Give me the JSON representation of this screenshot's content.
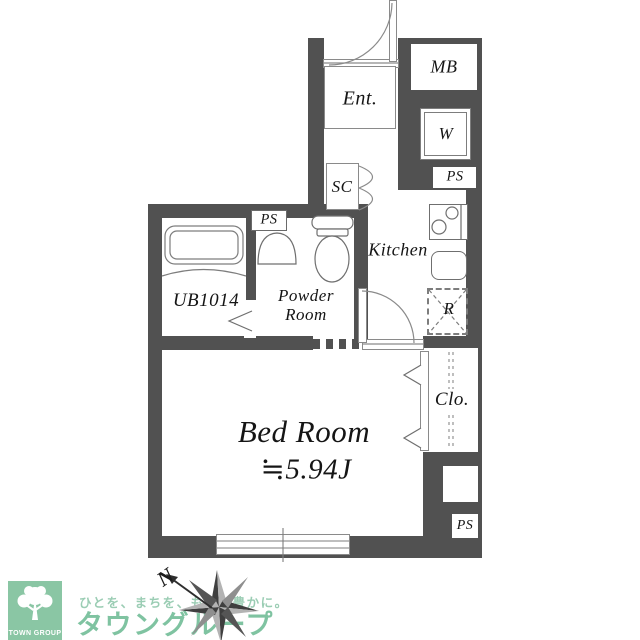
{
  "plan": {
    "ent": "Ent.",
    "mb": "MB",
    "w": "W",
    "ps": "PS",
    "sc": "SC",
    "kitchen": "Kitchen",
    "ub": "UB1014",
    "powder": "Powder Room",
    "r": "R",
    "bed_name": "Bed Room",
    "bed_size": "≒5.94J",
    "clo": "Clo."
  },
  "compass": {
    "north": "N"
  },
  "logo": {
    "company": "TOWN GROUP",
    "tagline": "ひとを、まちを、もっと豊かに。",
    "brand": "タウングループ"
  },
  "colors": {
    "wall": "#515151",
    "line": "#7d7d7d",
    "text": "#151515",
    "logo_green": "#8ac6a4",
    "brand_green": "#7fc3a1",
    "tagline_green": "#9bcdb4"
  }
}
